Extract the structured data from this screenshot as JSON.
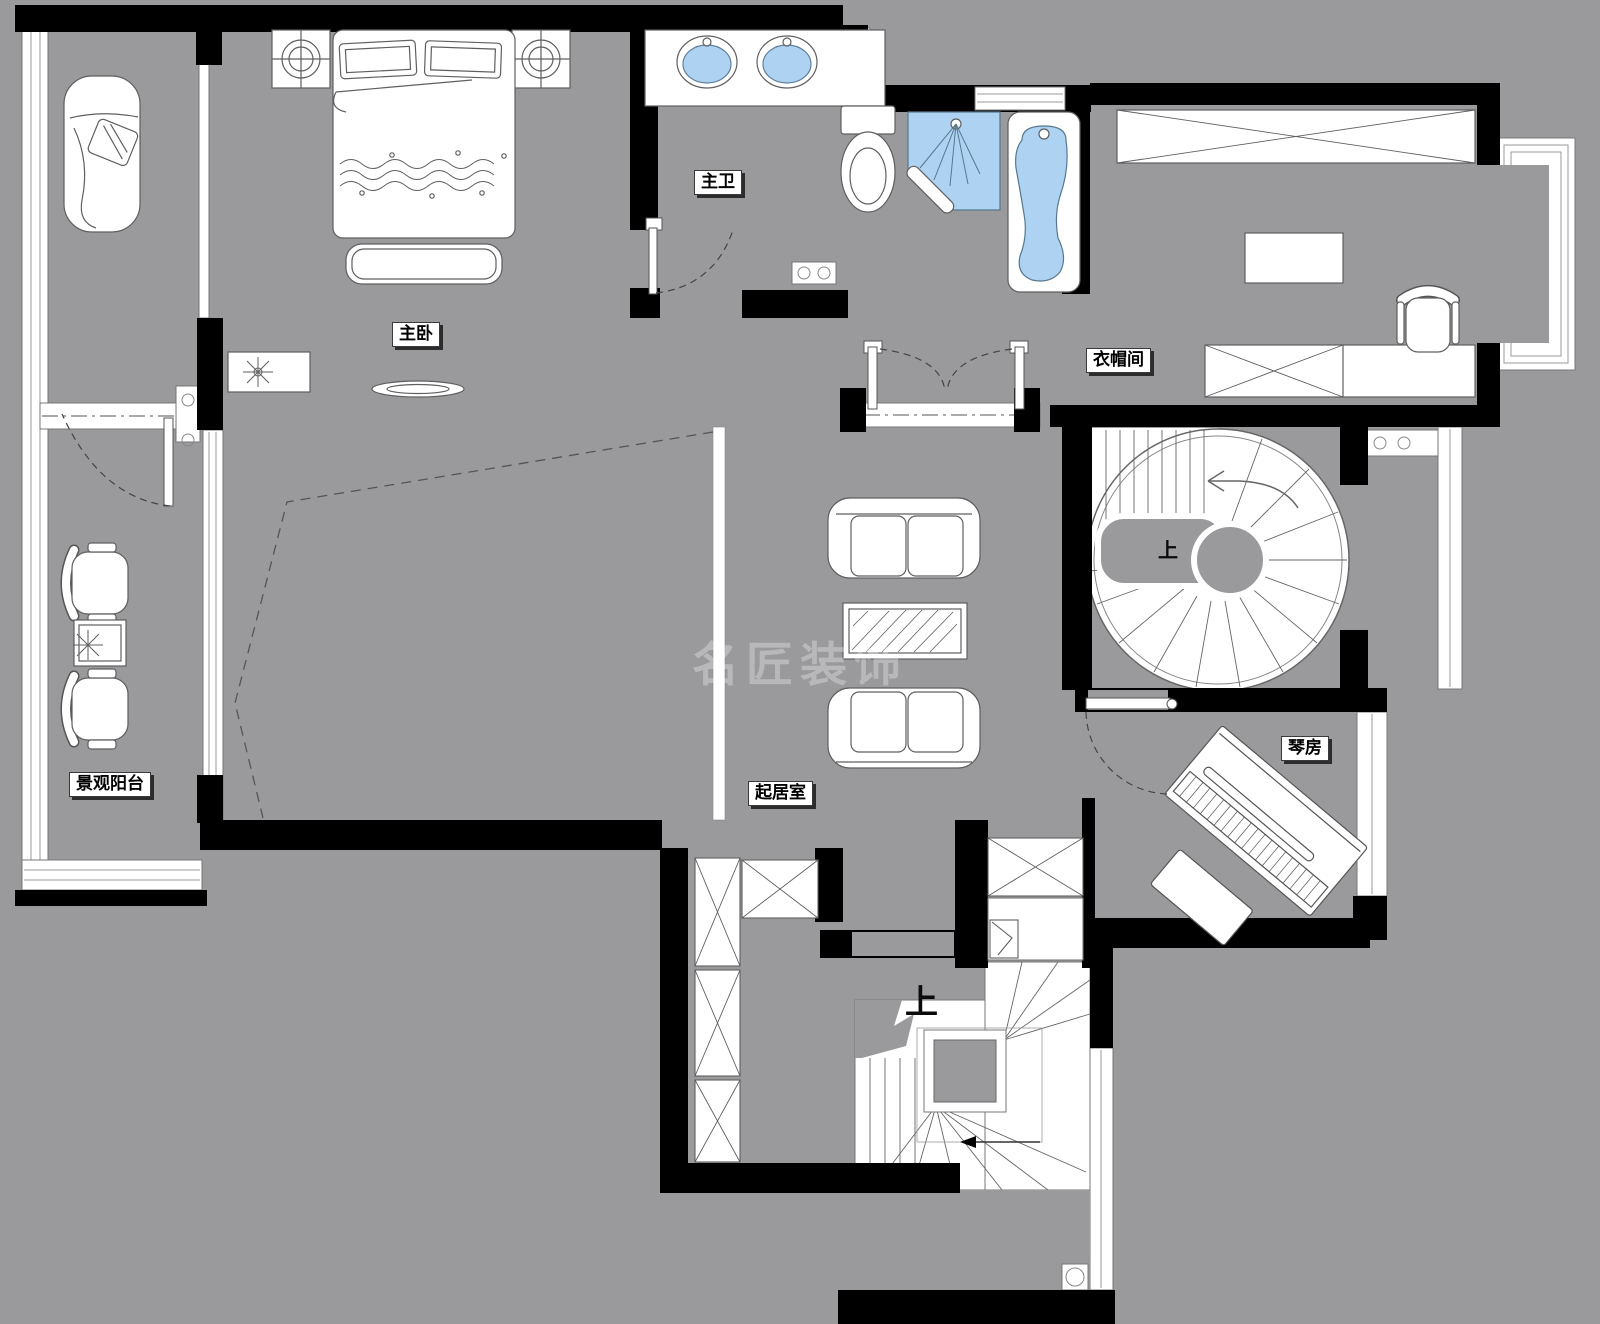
{
  "plan": {
    "watermark": "名匠装饰",
    "labels": {
      "master_bathroom": "主卫",
      "master_bedroom": "主卧",
      "cloakroom": "衣帽间",
      "living_room": "起居室",
      "piano_room": "琴房",
      "view_balcony": "景观阳台",
      "stairs_up_spiral": "上",
      "stairs_up_main": "上"
    },
    "colors": {
      "background": "#9a9a9c",
      "wall": "#000000",
      "furniture_fill": "#ffffff",
      "outline": "#5f5f5f",
      "water_blue": "#aed3f2",
      "label_bg": "#ffffff",
      "label_text": "#000000"
    }
  }
}
